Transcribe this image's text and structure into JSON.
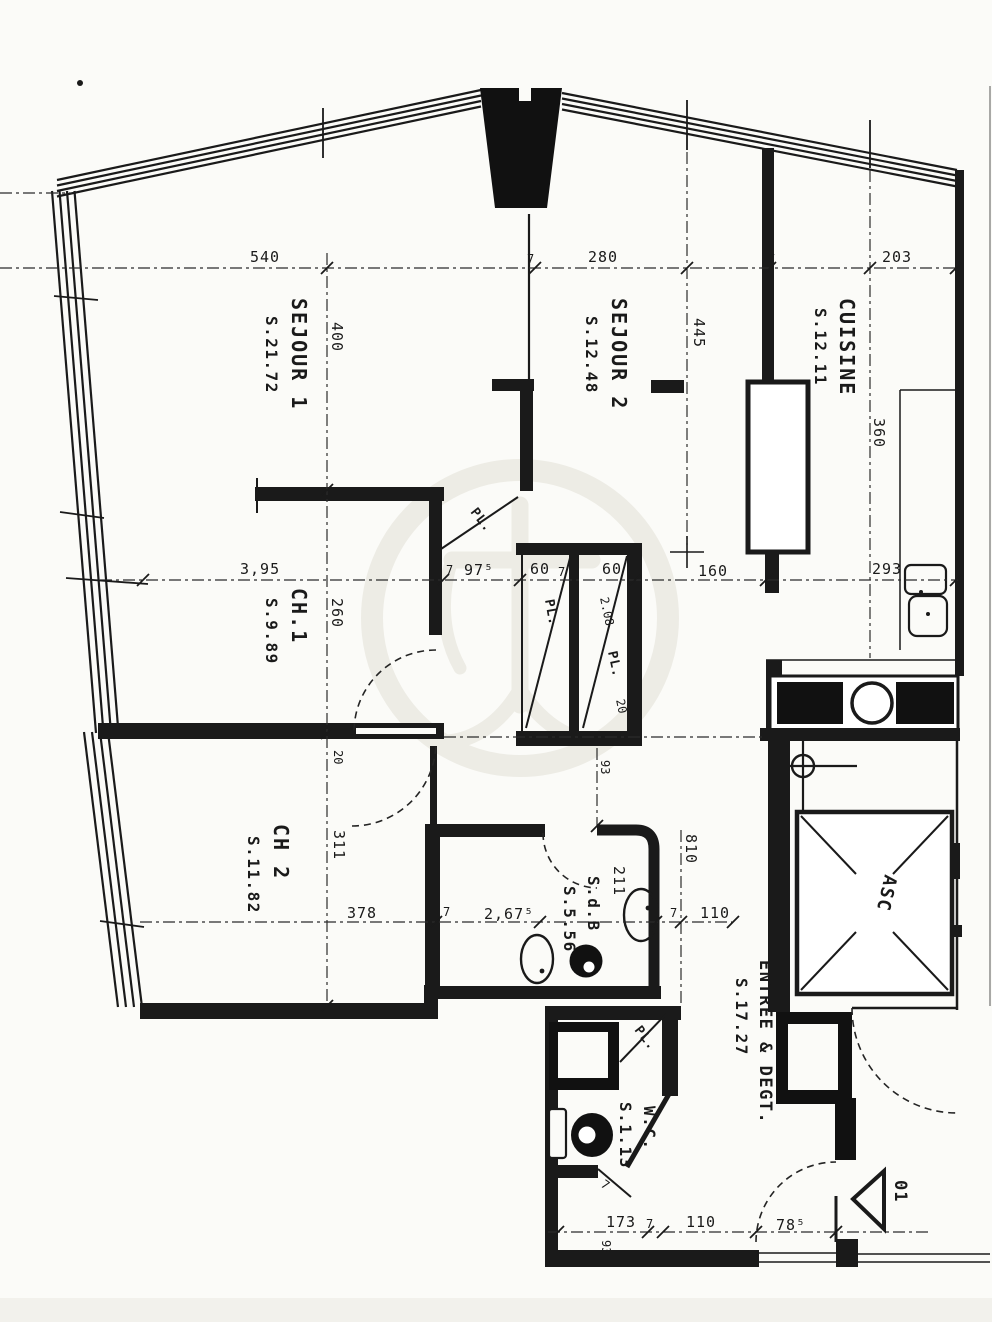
{
  "document": {
    "kind": "scanned apartment floor plan"
  },
  "colors": {
    "ink": "#1a1a1a",
    "paper": "#fbfbf8",
    "watermark": "#e2e0d6"
  },
  "rooms": {
    "sejour1": {
      "name": "SEJOUR 1",
      "area": "S.21.72"
    },
    "sejour2": {
      "name": "SEJOUR 2",
      "area": "S.12.48"
    },
    "cuisine": {
      "name": "CUISINE",
      "area": "S.12.11"
    },
    "ch1": {
      "name": "CH.1",
      "area": "S.9.89"
    },
    "ch2": {
      "name": "CH 2",
      "area": "S.11.82"
    },
    "sdb": {
      "name": "S.d.B",
      "area": "S.5.56"
    },
    "wc": {
      "name": "W.C.",
      "area": "S.1.13"
    },
    "entree": {
      "name": "ENTREE & DEGT.",
      "area": "S.17.27"
    },
    "asc": {
      "name": "ASC"
    }
  },
  "closets": {
    "pl1": "PL.",
    "pl2": "PL.",
    "pl3": "PL.",
    "pl3_len": "2.08",
    "pl3_w": "20",
    "pl4": "PL."
  },
  "dims": {
    "top": {
      "d540": "540",
      "s7a": "7",
      "d280": "280",
      "s7b": "7",
      "d203": "203"
    },
    "vleft": {
      "d400": "400",
      "d260": "260",
      "d20": "20",
      "d311": "311"
    },
    "vmid": {
      "d445": "445",
      "d360": "360"
    },
    "waist": {
      "d395": "3,95",
      "s7a": "7",
      "d975": "97⁵",
      "d60a": "60",
      "s7b": "7",
      "d60b": "60",
      "d160": "160",
      "s7c": "7",
      "d293": "293"
    },
    "ch2": {
      "d378": "378",
      "s7": "7"
    },
    "bath": {
      "d2675": "2,67⁵",
      "d211": "211",
      "d93": "93",
      "d810": "810",
      "s7": "7",
      "d110": "110"
    },
    "bottom": {
      "d173": "173",
      "s7a": "7",
      "d110": "110",
      "d785": "78⁵",
      "d93": "93",
      "s7b": "7"
    }
  },
  "marker": {
    "d01": "01"
  }
}
